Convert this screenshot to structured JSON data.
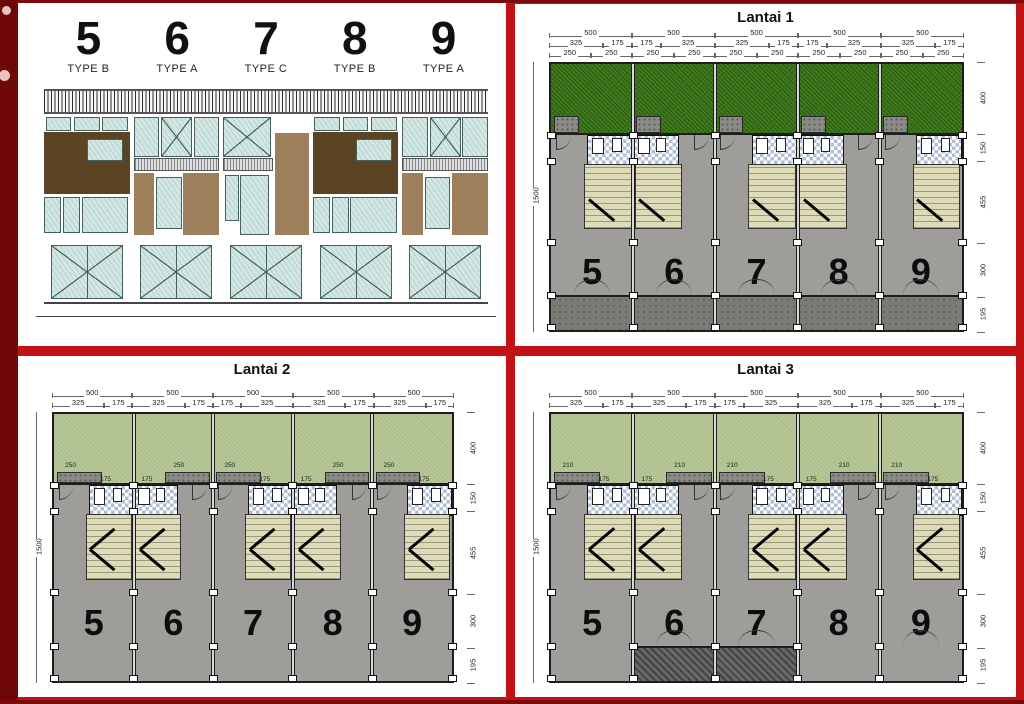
{
  "page": {
    "background": "#c11315",
    "left_strip": "#6f0707",
    "edge_dark": "#7c0a0a"
  },
  "elevation": {
    "units": [
      {
        "number": "5",
        "type": "TYPE B"
      },
      {
        "number": "6",
        "type": "TYPE A"
      },
      {
        "number": "7",
        "type": "TYPE C"
      },
      {
        "number": "8",
        "type": "TYPE B"
      },
      {
        "number": "9",
        "type": "TYPE A"
      }
    ]
  },
  "floors": [
    {
      "title": "Lantai 1",
      "units": [
        "5",
        "6",
        "7",
        "8",
        "9"
      ],
      "dim_unit_width": [
        "500",
        "500",
        "500",
        "500",
        "500"
      ],
      "dim_splits": [
        [
          "325",
          "175"
        ],
        [
          "175",
          "325"
        ],
        [
          "325",
          "175"
        ],
        [
          "175",
          "325"
        ],
        [
          "325",
          "175"
        ]
      ],
      "dim_quarters": [
        "250",
        "250"
      ],
      "dim_left": "1500",
      "dims_right": [
        "400",
        "150",
        "455",
        "300",
        "195"
      ],
      "garden": "dark",
      "planter_dim": "",
      "core_dim": ""
    },
    {
      "title": "Lantai 2",
      "units": [
        "5",
        "6",
        "7",
        "8",
        "9"
      ],
      "dim_unit_width": [
        "500",
        "500",
        "500",
        "500",
        "500"
      ],
      "dim_splits": [
        [
          "325",
          "175"
        ],
        [
          "325",
          "175"
        ],
        [
          "175",
          "325"
        ],
        [
          "325",
          "175"
        ],
        [
          "325",
          "175"
        ]
      ],
      "dim_quarters": null,
      "dim_left": "1500",
      "dims_right": [
        "400",
        "150",
        "455",
        "300",
        "195"
      ],
      "garden": "light",
      "planter_dim": "250",
      "core_dim": "175"
    },
    {
      "title": "Lantai 3",
      "units": [
        "5",
        "6",
        "7",
        "8",
        "9"
      ],
      "dim_unit_width": [
        "500",
        "500",
        "500",
        "500",
        "500"
      ],
      "dim_splits": [
        [
          "325",
          "175"
        ],
        [
          "325",
          "175"
        ],
        [
          "175",
          "325"
        ],
        [
          "325",
          "175"
        ],
        [
          "325",
          "175"
        ]
      ],
      "dim_quarters": null,
      "dim_left": "1500",
      "dims_right": [
        "400",
        "150",
        "455",
        "300",
        "195"
      ],
      "garden": "light",
      "planter_dim": "210",
      "core_dim": "175"
    }
  ],
  "colors": {
    "grass_dark": "#3b7818",
    "grass_light": "#b7c795",
    "floor_gray": "#9e9d99",
    "drive_gray": "#7b7a74",
    "stair_beige": "#dedcb8",
    "bath_tile": "#aebfd3",
    "wall": "#1d1d1d",
    "brown_dark": "#5b4423",
    "brown_light": "#9d7f5c",
    "glass": "#d2e8e4"
  }
}
